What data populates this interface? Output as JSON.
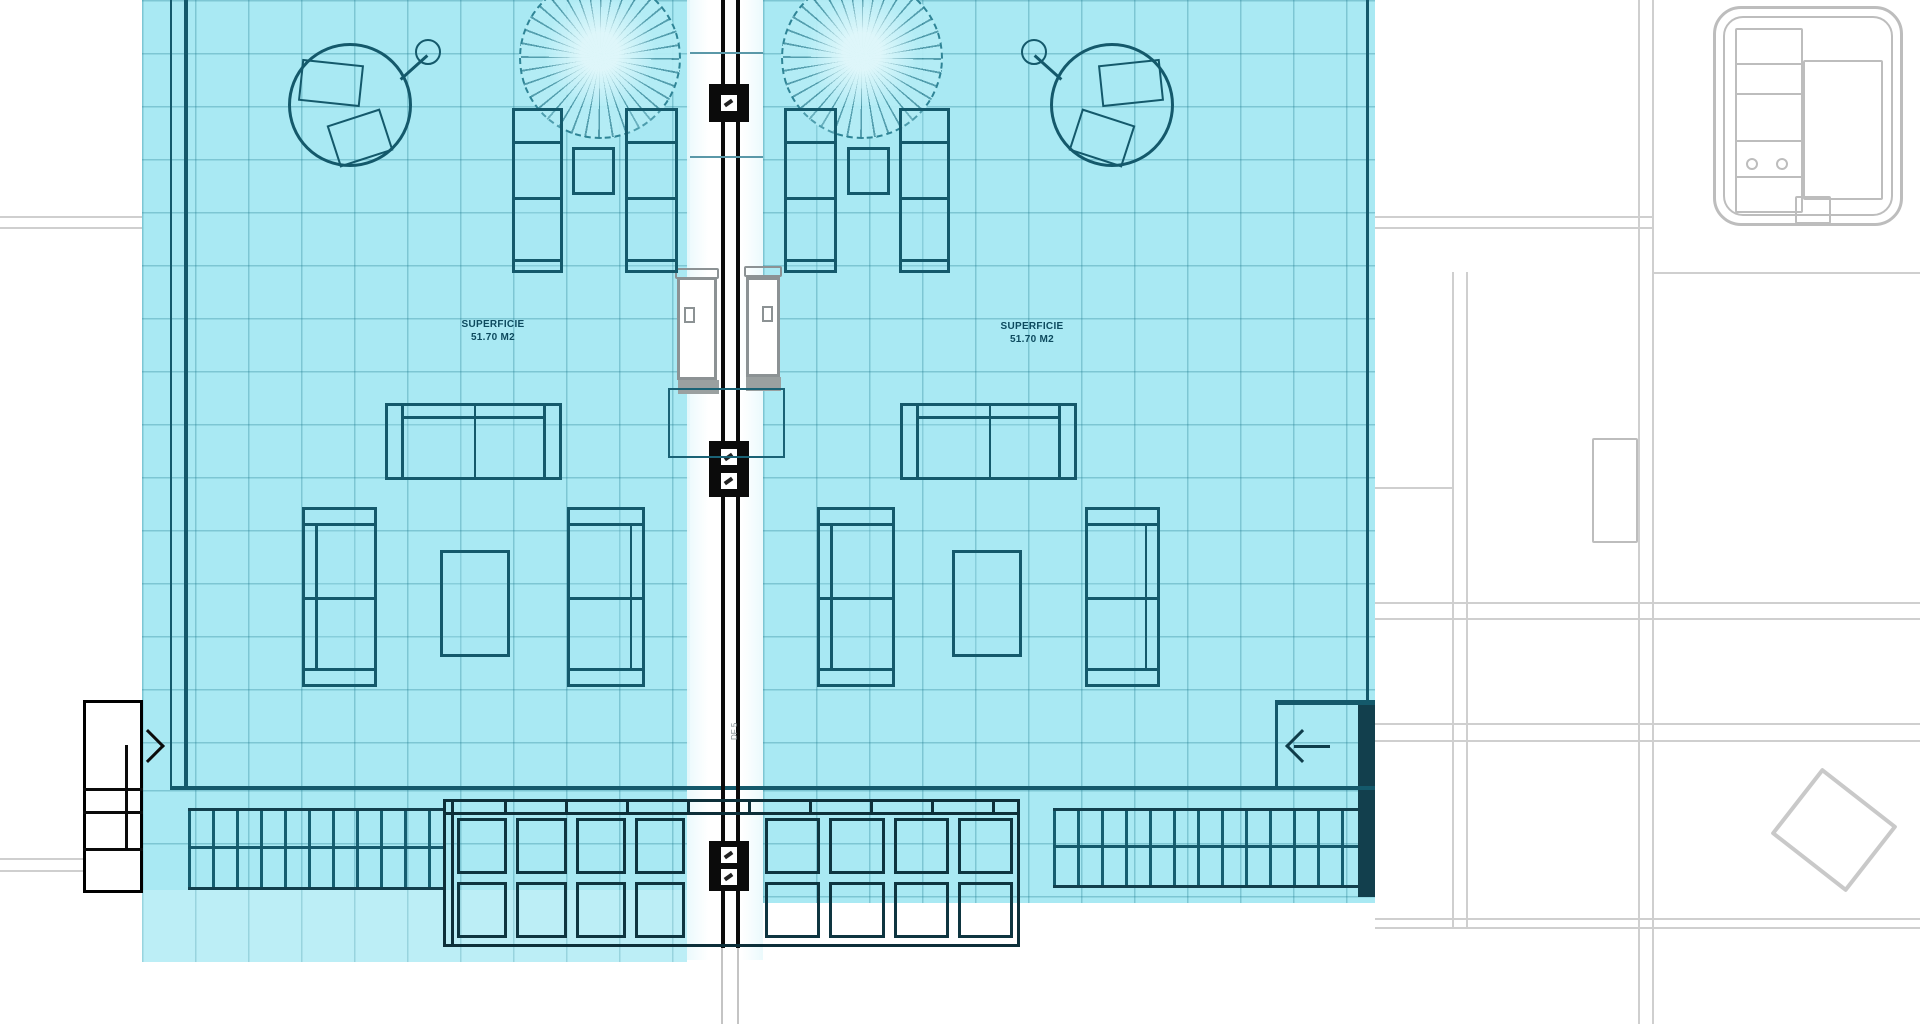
{
  "plan": {
    "center_label": "DF 5",
    "units": [
      {
        "line1": "SUPERFICIE",
        "line2": "51.70 M2"
      },
      {
        "line1": "SUPERFICIE",
        "line2": "51.70 M2"
      }
    ]
  },
  "colors": {
    "highlight": "#a9e9f3",
    "highlight_light": "#bceef6",
    "outline": "#14596b",
    "wall": "#0b0b0b",
    "background_lines": "#cfcfcf",
    "door": "#8c9294"
  },
  "icons": [
    "parasol-icon",
    "sun-lounger-icon",
    "side-table-icon",
    "outdoor-shower-icon",
    "sofa-icon",
    "armchair-icon",
    "coffee-table-icon",
    "stairs-icon",
    "pergola-grid-icon",
    "entry-arrow-icon",
    "column-marker-icon",
    "jacuzzi-plan-icon",
    "diamond-marker-icon"
  ]
}
